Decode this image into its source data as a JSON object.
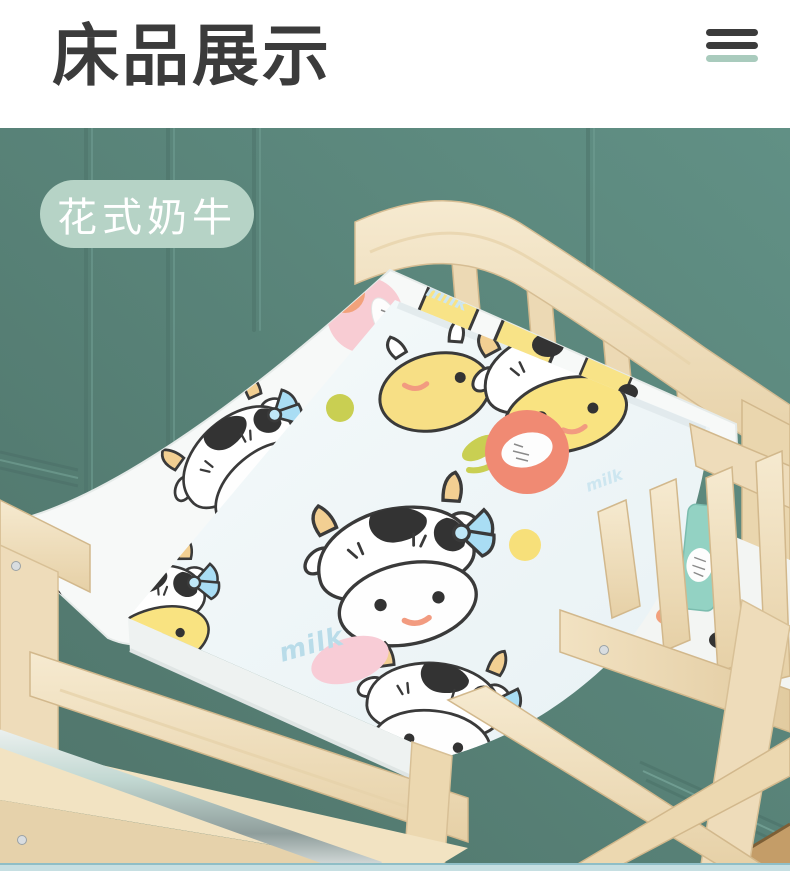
{
  "header": {
    "title": "床品展示",
    "menu_icon": "menu-icon"
  },
  "overlay": {
    "badge_label": "花式奶牛"
  },
  "photo": {
    "fabric_scribble_text": "milk"
  },
  "colors": {
    "wall_teal": "#57837a",
    "accent_mint": "#b6d3c6",
    "title_dark": "#3b3b3b",
    "wood_light": "#f0e0c2",
    "bow_blue": "#a9ddf4",
    "flower_salmon": "#f08a73",
    "bottom_strip": "#c6dfe2"
  }
}
